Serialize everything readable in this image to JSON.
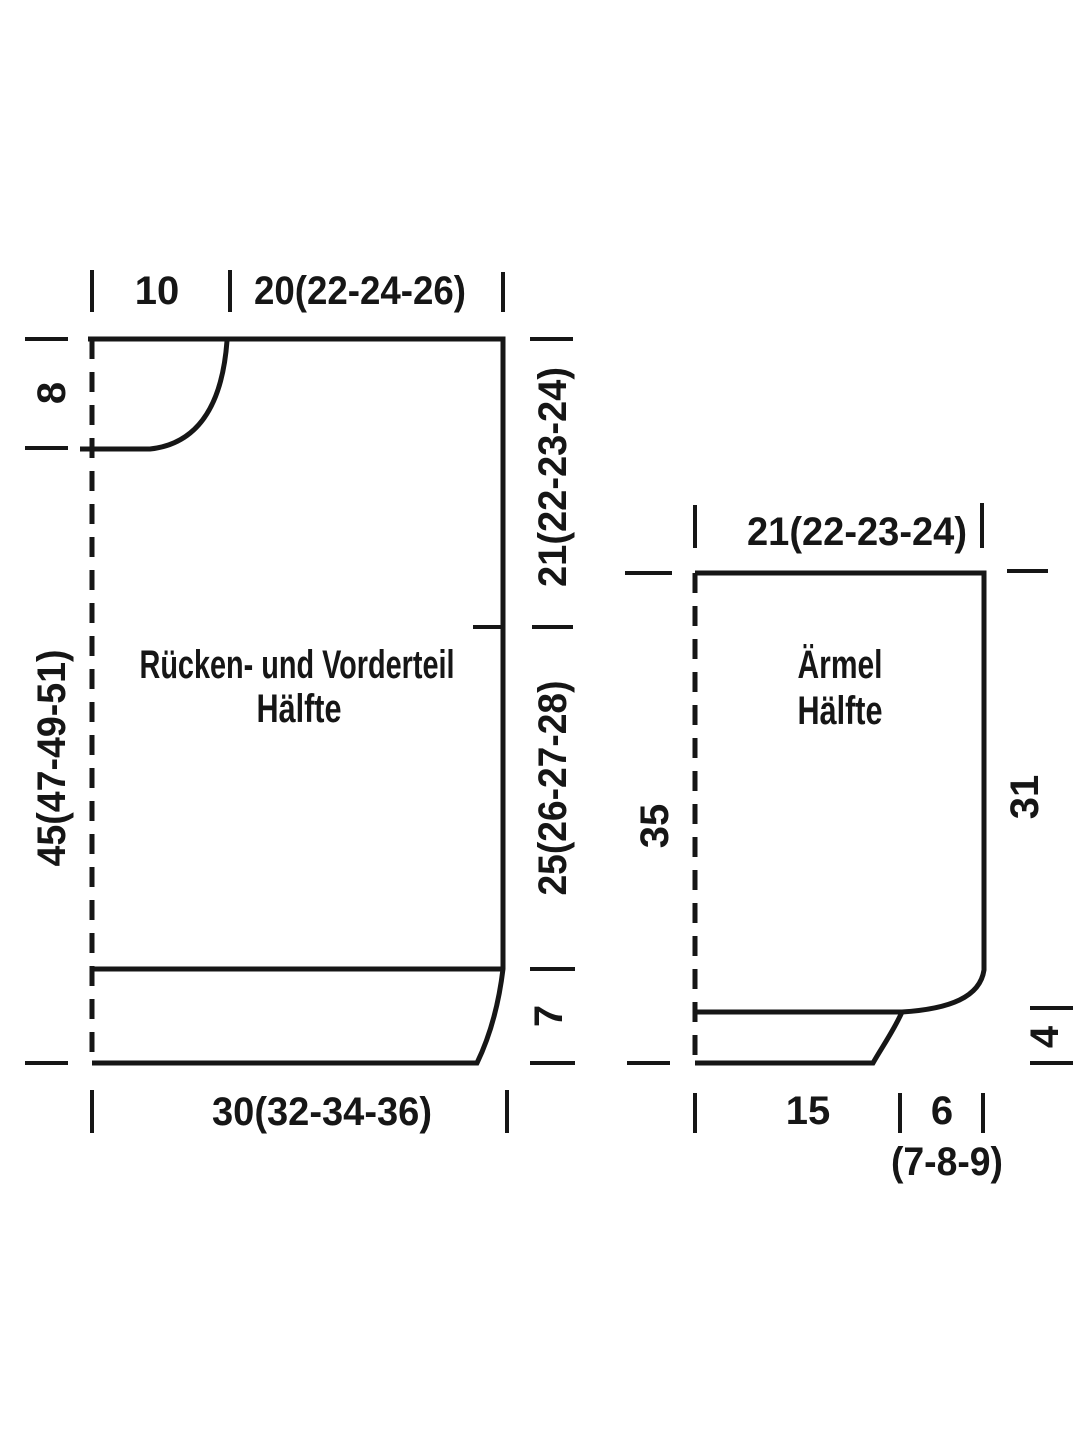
{
  "pieces": {
    "body": {
      "title_line1": "Rücken- und Vorderteil",
      "title_line2": "Hälfte",
      "top_segment1": "10",
      "top_segment2": "20(22-24-26)",
      "left_neck_depth": "8",
      "left_length": "45(47-49-51)",
      "right_upper": "21(22-23-24)",
      "right_lower": "25(26-27-28)",
      "right_ribbing": "7",
      "bottom_width": "30(32-34-36)"
    },
    "sleeve": {
      "title_line1": "Ärmel",
      "title_line2": "Hälfte",
      "top_width": "21(22-23-24)",
      "left_length": "35",
      "right_length": "31",
      "right_cuff": "4",
      "bottom_segment1": "15",
      "bottom_segment2": "6",
      "bottom_segment2_sizes": "(7-8-9)"
    }
  },
  "colors": {
    "ink": "#161616",
    "background": "#ffffff"
  }
}
